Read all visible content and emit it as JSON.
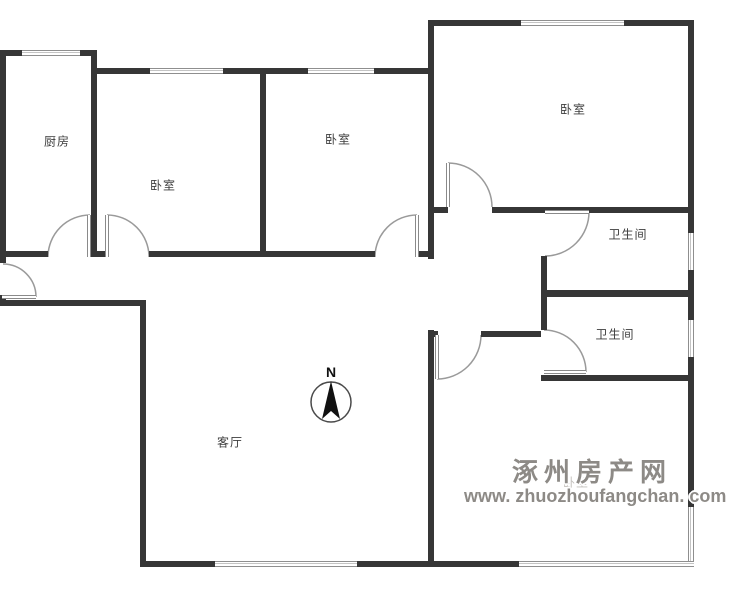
{
  "rooms": {
    "kitchen": {
      "label": "厨房"
    },
    "bedroom_left": {
      "label": "卧室"
    },
    "bedroom_middle": {
      "label": "卧室"
    },
    "bedroom_top_right": {
      "label": "卧室"
    },
    "bathroom_upper": {
      "label": "卫生间"
    },
    "bathroom_lower": {
      "label": "卫生间"
    },
    "living_room": {
      "label": "客厅"
    },
    "bedroom_bottom_right": {
      "label": "卧室"
    }
  },
  "compass": {
    "north_label": "N"
  },
  "watermark": {
    "site_name": "涿州房产网",
    "site_url": "www. zhuozhoufangchan. com"
  },
  "colors": {
    "wall": "#363636",
    "window_frame": "#8f8f8f",
    "door_arc": "#9a9a9a",
    "room_label": "#3d3d3d",
    "watermark_text": "#8d8a86"
  }
}
